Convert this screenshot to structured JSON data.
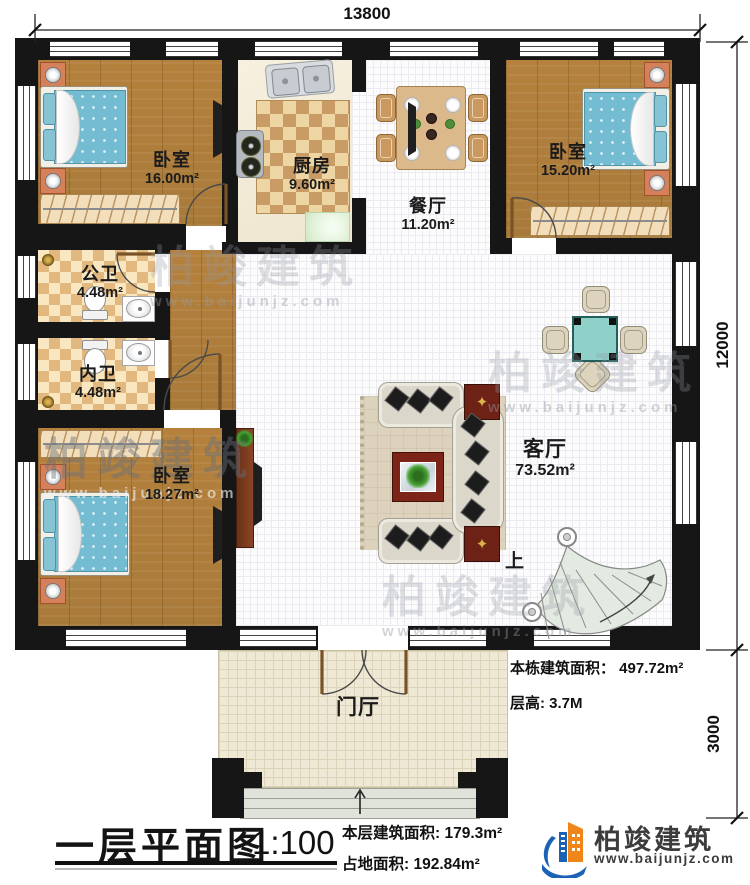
{
  "dimensions": {
    "top": "13800",
    "right_upper": "12000",
    "right_lower": "3000"
  },
  "rooms": [
    {
      "name": "卧室",
      "area": "16.00m²"
    },
    {
      "name": "厨房",
      "area": "9.60m²"
    },
    {
      "name": "餐厅",
      "area": "11.20m²"
    },
    {
      "name": "卧室",
      "area": "15.20m²"
    },
    {
      "name": "公卫",
      "area": "4.48m²"
    },
    {
      "name": "内卫",
      "area": "4.48m²"
    },
    {
      "name": "卧室",
      "area": "18.27m²"
    },
    {
      "name": "客厅",
      "area": "73.52m²"
    },
    {
      "name": "门厅",
      "area": ""
    }
  ],
  "stairs": {
    "direction_label": "上"
  },
  "notes": {
    "building_area": "本栋建筑面积： 497.72m²",
    "floor_height": "层高: 3.7M"
  },
  "footer": {
    "title": "一层平面图",
    "scale": "1:100",
    "floor_area": "本层建筑面积: 179.3m²",
    "land_area": "占地面积: 192.84m²"
  },
  "brand": {
    "name": "柏竣建筑",
    "url": "www.baijunjz.com"
  },
  "watermark": {
    "text": "柏竣建筑",
    "url": "www.baijunjz.com"
  }
}
